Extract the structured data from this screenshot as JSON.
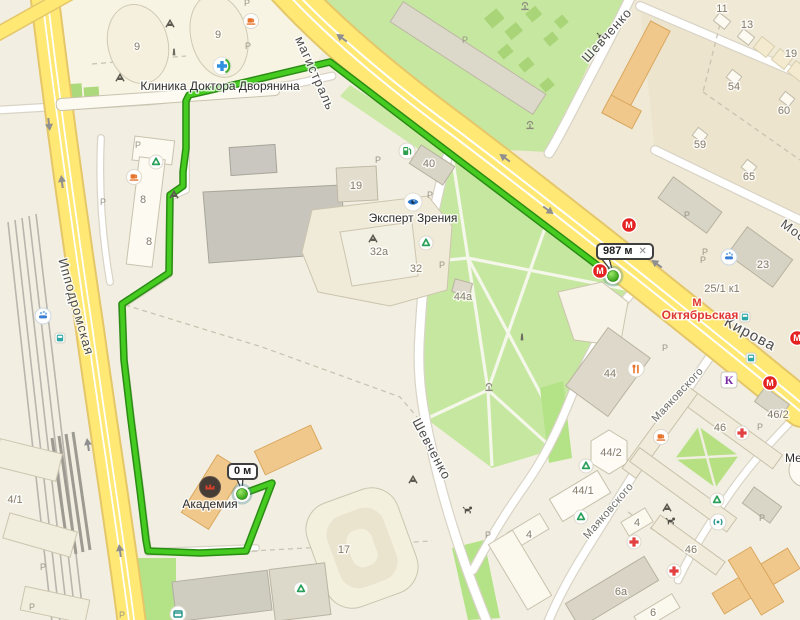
{
  "route": {
    "total_distance": "987 м",
    "remaining_distance": "0 м",
    "close_icon": "✕"
  },
  "streets": {
    "magistral": "магистраль",
    "shevchenko_top": "Шевченко",
    "shevchenko_mid": "Шевченко",
    "ippodromskaya": "Ипподромская",
    "kirova": "Кирова",
    "mayakovskogo_1": "Маяковского",
    "mayakovskogo_2": "Маяковского",
    "mos_partial": "Мос"
  },
  "places": {
    "clinic": "Клиника Доктора Дворянина",
    "optics": "Эксперт Зрения",
    "academy": "Академия",
    "metro_station": "Октябрьская",
    "me_partial": "Ме"
  },
  "metro_letter": "М",
  "k_store_letter": "К",
  "parking_letter": "Р",
  "buildings": {
    "b9_1": "9",
    "b9_2": "9",
    "b8_1": "8",
    "b8_2": "8",
    "b19_left": "19",
    "b40": "40",
    "b32a": "32а",
    "b32": "32",
    "b44a": "44а",
    "b11": "11",
    "b13": "13",
    "b19_right": "19",
    "b54": "54",
    "b60": "60",
    "b59": "59",
    "b65": "65",
    "b23": "23",
    "b25_1k1": "25/1 к1",
    "b44": "44",
    "b44_2": "44/2",
    "b44_1": "44/1",
    "b46_2": "46/2",
    "b46_a": "46",
    "b46_b": "46",
    "b4_a": "4",
    "b4_b": "4",
    "b6a": "6а",
    "b6": "6",
    "b17": "17",
    "b4_1": "4/1"
  }
}
